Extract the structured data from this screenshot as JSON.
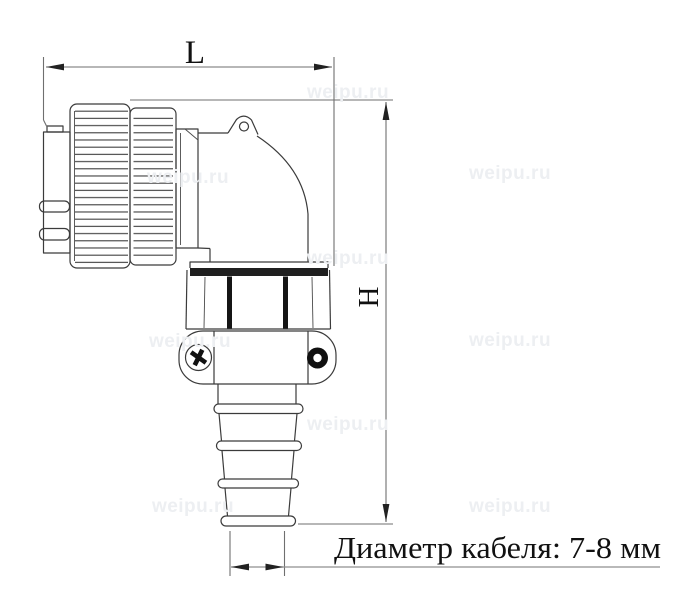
{
  "labels": {
    "dimension_length": "L",
    "dimension_height": "H",
    "cable_note": "Диаметр кабеля: 7-8 мм"
  },
  "watermark": {
    "text": "weipu.ru",
    "color": "#edeff2"
  },
  "colors": {
    "background": "#ffffff",
    "drawing_line": "#3b3b3b",
    "dimension_line": "#6f6f6f",
    "leader_line": "#8f8f8f",
    "arrow": "#222222",
    "label_text": "#111111",
    "nut_band": "#1f1f1f"
  }
}
